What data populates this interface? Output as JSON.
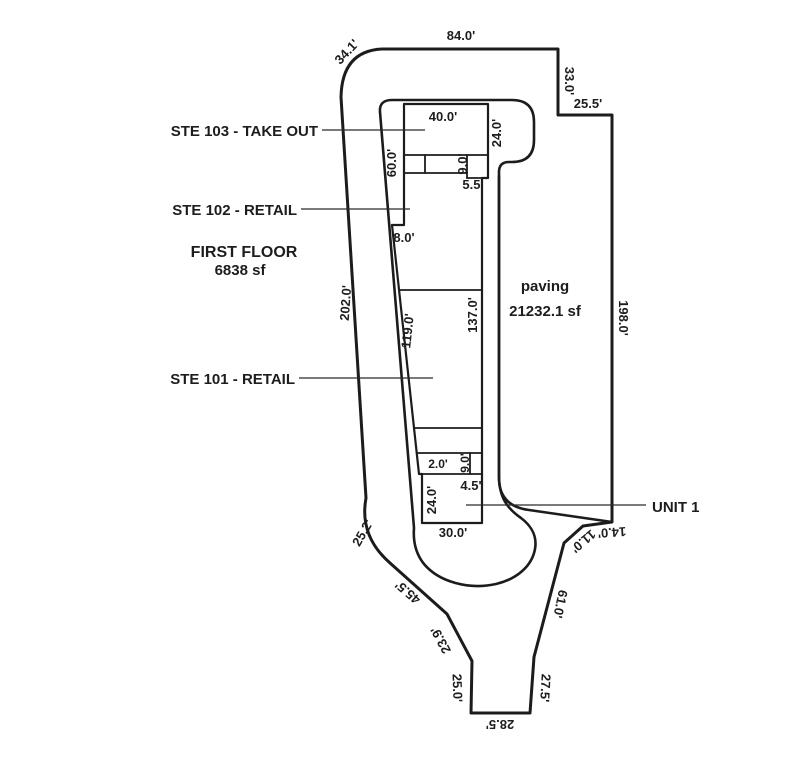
{
  "plan": {
    "suites": {
      "ste103": "STE 103 - TAKE OUT",
      "ste102": "STE 102 - RETAIL",
      "ste101": "STE 101 - RETAIL",
      "unit1": "UNIT 1"
    },
    "floor": {
      "name": "FIRST FLOOR",
      "area": "6838 sf"
    },
    "paving": {
      "name": "paving",
      "area": "21232.1 sf"
    },
    "dims": {
      "corner_34_1": "34.1'",
      "top_84": "84.0'",
      "step_33": "33.0'",
      "step_25_5": "25.5'",
      "right_198": "198.0'",
      "left_202": "202.0'",
      "ste103_w_40": "40.0'",
      "ste103_h_24": "24.0'",
      "left_60": "60.0'",
      "corridor_9": "9.0'",
      "step_5_5": "5.5'",
      "step_8": "8.0'",
      "bldg_right_137": "137.0'",
      "left_119": "119.0'",
      "row_2": "2.0'",
      "row_9": "9.0'",
      "unit1_4_5": "4.5'",
      "unit1_h_24": "24.0'",
      "unit1_w_30": "30.0'",
      "se_14": "14.0'",
      "se_11": "11.0'",
      "se_61": "61.0'",
      "se_27_5": "27.5'",
      "bottom_28_5": "28.5'",
      "sw_25_0": "25.0'",
      "sw_23_9": "23.9'",
      "sw_45_5": "45.5'",
      "sw_25_2": "25.2'"
    },
    "colors": {
      "parcel": "#8f8f8f",
      "pad": "#c8c8c8",
      "building": "#e2e2e2",
      "outline": "#1c1c1c"
    }
  }
}
